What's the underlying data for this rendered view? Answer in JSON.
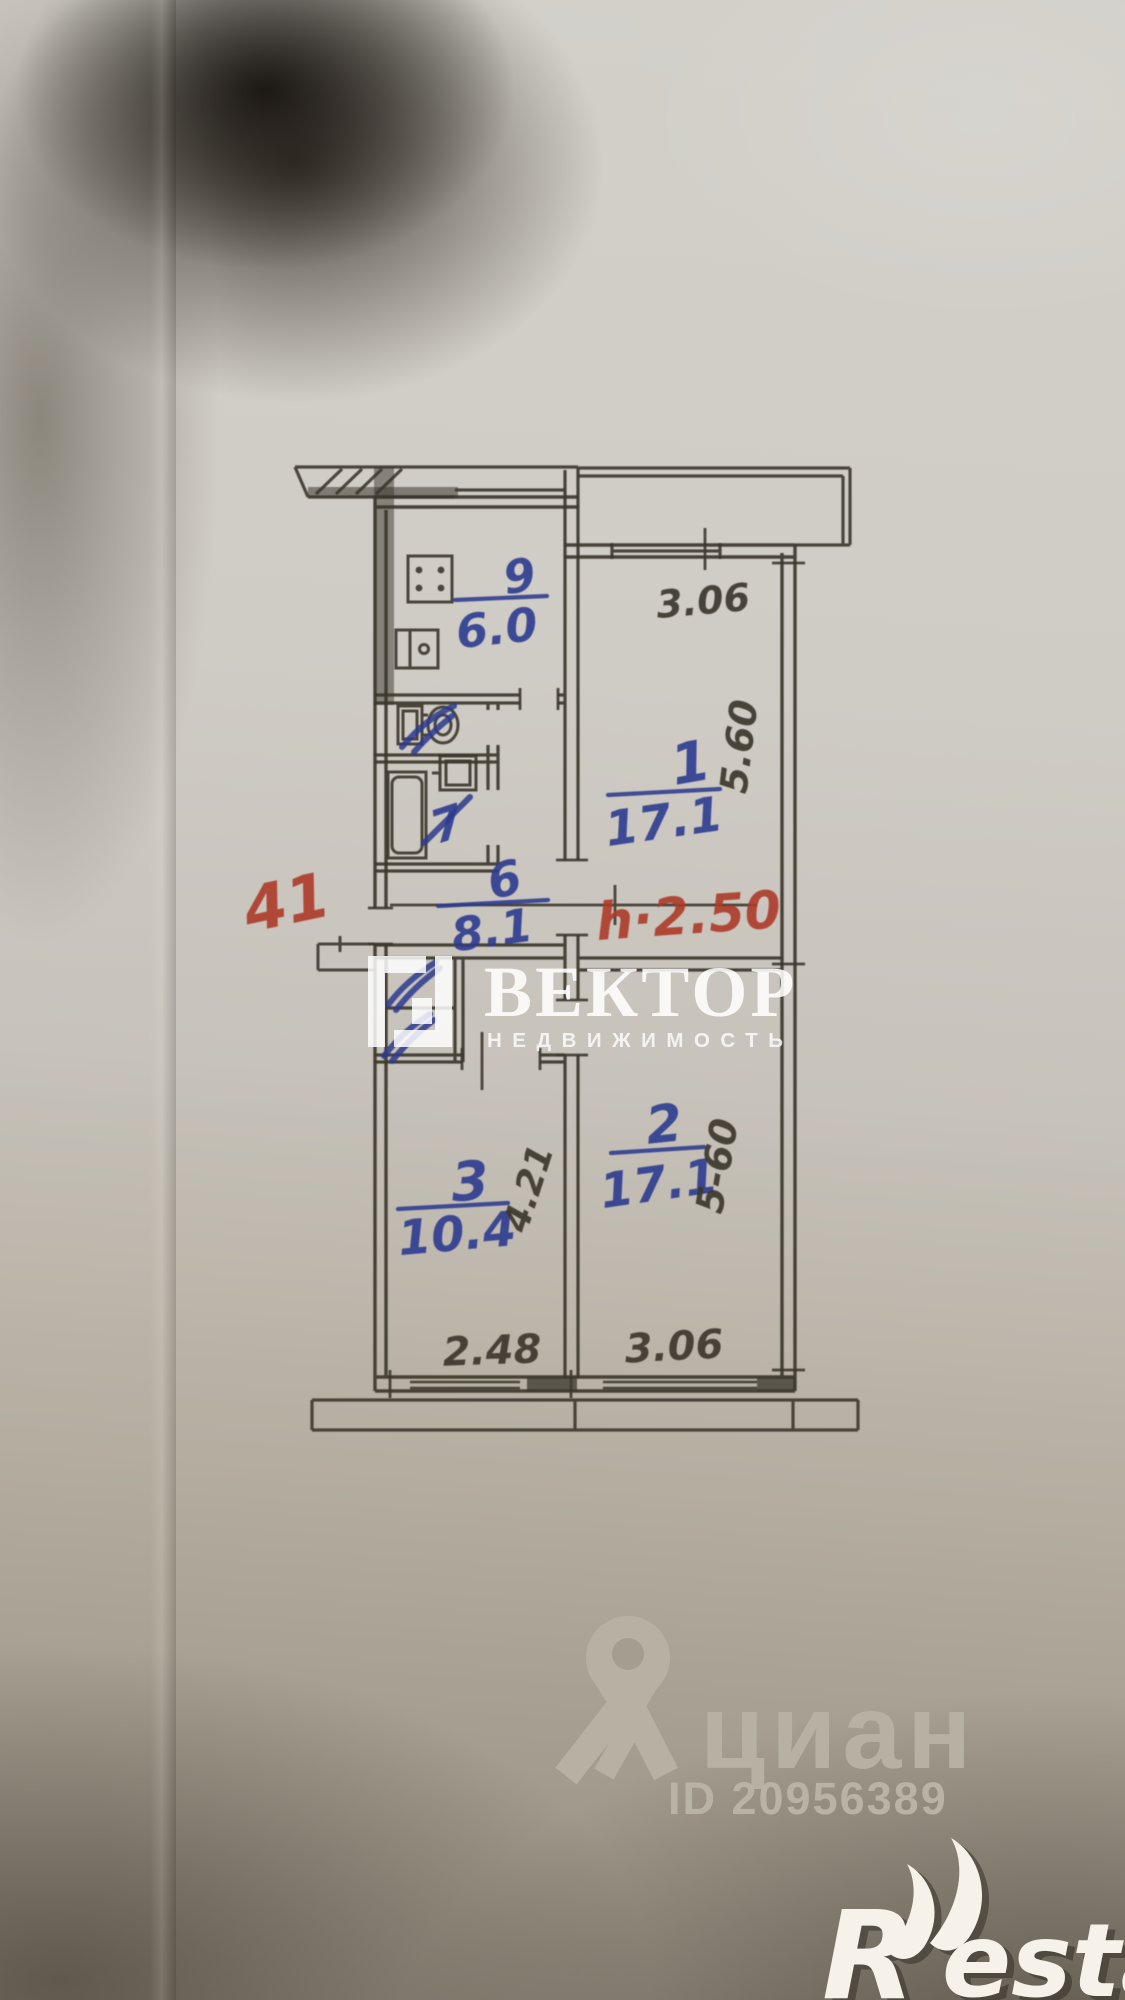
{
  "plan": {
    "kitchen_num": "9",
    "kitchen_area": "6.0",
    "room1_num": "1",
    "room1_area": "17.1",
    "hall_num": "6",
    "hall_area": "8.1",
    "bath_num": "7",
    "room2_num": "2",
    "room2_area": "17.1",
    "room3_num": "3",
    "room3_area": "10.4",
    "dim_room1_width": "3.06",
    "dim_room1_depth": "5.60",
    "dim_room2_depth": "5-60",
    "dim_room3_depth": "4.21",
    "dim_bottom_left": "2.48",
    "dim_bottom_right": "3.06",
    "note_unit": "41",
    "note_height": "h·2.50"
  },
  "watermarks": {
    "vektor_title": "ВЕКТОР",
    "vektor_subtitle": "НЕДВИЖИМОСТЬ",
    "cian_name": "циан",
    "cian_id": "ID 20956389",
    "restate_r": "R",
    "restate_rest": "estate"
  },
  "colors": {
    "ink": "#3c372d",
    "blue_pen": "#2c3a8f",
    "red_pen": "#ad3a29",
    "paper": "#cecac3",
    "watermark_white": "#f2ede4",
    "watermark_gray": "#b7b1a4"
  }
}
